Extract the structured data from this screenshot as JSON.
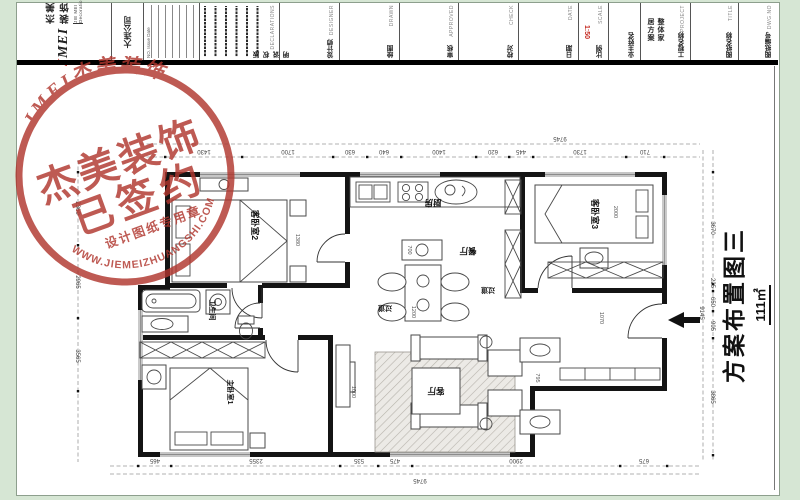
{
  "title_block": {
    "logo": {
      "brand_j": "J",
      "brand_rest": "MEI",
      "cn": "杰美装饰",
      "en": "JIE MEI Decoration"
    },
    "company": "大连公司",
    "revisions": {
      "header": "NO.  Issue  Date"
    },
    "cells": {
      "declaration": {
        "cn": "版权说明",
        "en": "DECLARATIONS"
      },
      "designer": {
        "cn": "设计师",
        "en": "DESIGNER"
      },
      "drawn": {
        "cn": "绘图",
        "en": "DRAWN"
      },
      "approved": {
        "cn": "审核",
        "en": "APPROVED"
      },
      "check": {
        "cn": "校对",
        "en": "CHECK"
      },
      "date": {
        "cn": "日期",
        "en": "DATE"
      },
      "scale": {
        "cn": "比例",
        "en": "SCALE",
        "value": "1:50"
      },
      "owner": {
        "cn": "业主姓名",
        "en": ""
      },
      "project": {
        "cn": "工程名称",
        "en": "PROJECT",
        "value": "整体家居方案"
      },
      "title": {
        "cn": "图纸名称",
        "en": "TITLE"
      },
      "dwgno": {
        "cn": "图纸编号",
        "en": "DWG.NO"
      }
    }
  },
  "stamp": {
    "arc_top": "JMEI杰美装饰",
    "line1": "杰美装饰",
    "line2": "已签约",
    "line3": "设计图纸专用章",
    "arc_bottom": "WWW.JIEMEIZHUANGSHI.COM",
    "color": "#b0362e"
  },
  "drawing_label": {
    "title": "方案布置图三",
    "area": "111㎡"
  },
  "floor_plan": {
    "rooms": {
      "bedroom2": "客卧室2",
      "kitchen": "厨房",
      "dining": "餐厅",
      "bedroom3": "客卧室3",
      "bath": "卫生间",
      "hall1": "过道",
      "hall2": "过道",
      "living": "客厅",
      "master": "主卧室1"
    },
    "dims_top": {
      "total": "9745",
      "segments": [
        "1430",
        "1700",
        "630",
        "640",
        "1400",
        "620",
        "445",
        "1730",
        "710"
      ]
    },
    "dims_bottom": {
      "total": "9745",
      "segments": [
        "465",
        "2355",
        "535",
        "475",
        "2900",
        "675"
      ]
    },
    "dims_right": {
      "total": "9145",
      "segments": [
        "3670",
        "225",
        "650",
        "905",
        "3865"
      ]
    },
    "dims_left": {
      "segments": [
        "2360",
        "2965",
        "3565"
      ]
    },
    "inner_dims": {
      "bed2": "1380",
      "dining_w": "700",
      "dining_l": "1200",
      "bed3": "2000",
      "entry": "1070",
      "sofa": "795",
      "tv": "1000"
    }
  }
}
